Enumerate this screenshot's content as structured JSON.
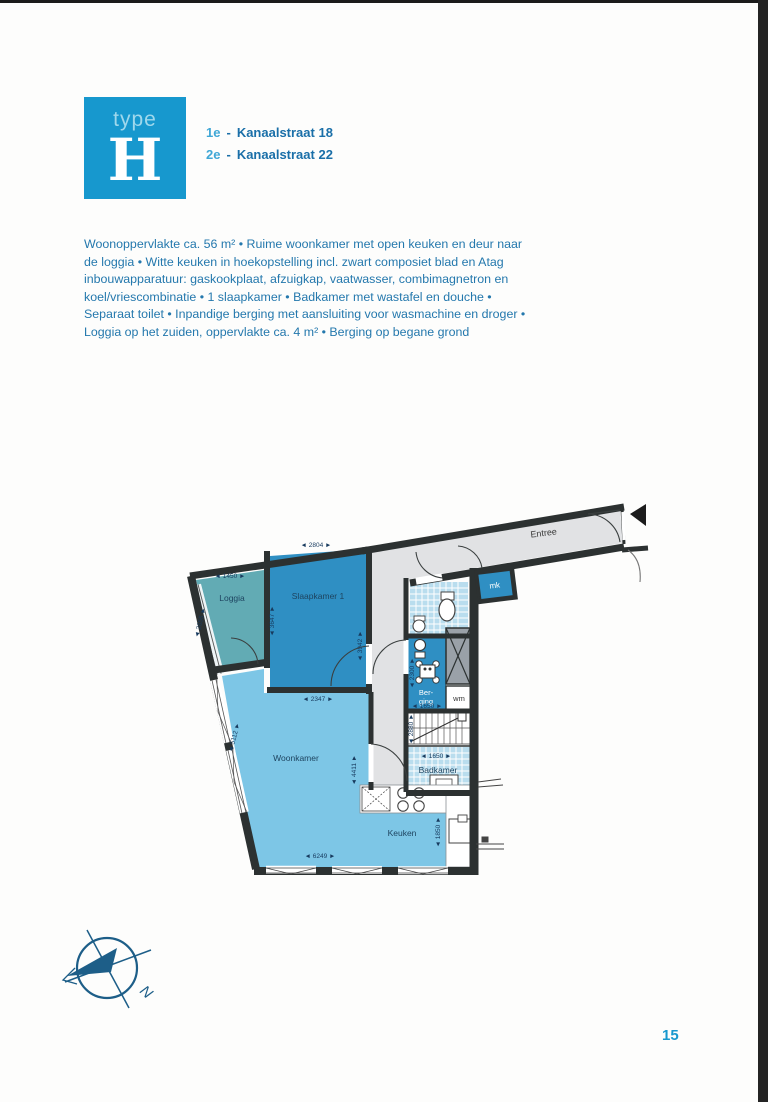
{
  "page": {
    "number": "15"
  },
  "logo": {
    "type_label": "type",
    "letter": "H",
    "bg_color": "#1798ce"
  },
  "addresses": [
    {
      "prefix": "1e",
      "sep": "-",
      "name": "Kanaalstraat 18"
    },
    {
      "prefix": "2e",
      "sep": "-",
      "name": "Kanaalstraat 22"
    }
  ],
  "description": "Woonoppervlakte ca. 56 m² • Ruime woonkamer met open keuken en deur naar de loggia • Witte keuken in hoekopstelling incl. zwart composiet blad en Atag inbouwapparatuur: gaskookplaat, afzuigkap, vaatwasser, combimagnetron en koel/vriescombinatie • 1 slaapkamer • Badkamer met wastafel en douche • Separaat toilet • Inpandige berging met aansluiting voor wasmachine en droger • Loggia op het zuiden, oppervlakte ca. 4 m² • Berging op begane grond",
  "floorplan": {
    "labels": {
      "entree": "Entree",
      "loggia": "Loggia",
      "slaapkamer": "Slaapkamer 1",
      "woonkamer": "Woonkamer",
      "keuken": "Keuken",
      "badkamer": "Badkamer",
      "berging_line1": "Ber-",
      "berging_line2": "ging",
      "mk": "mk",
      "wm": "wm"
    },
    "dimensions": {
      "slaapkamer_top": "◄ 2804 ►",
      "loggia_top": "◄ 1450 ►",
      "loggia_left": "◄ 2655 ►",
      "slaapkamer_left": "◄ 3647 ►",
      "slaapkamer_right": "◄ 3942 ►",
      "slaapkamer_bottom": "◄ 2347 ►",
      "woonkamer_left": "◄ 5112 ►",
      "keuken_left": "◄ 4411 ►",
      "woonkamer_bottom": "◄ 6249 ►",
      "berging_left": "◄ 2300 ►",
      "berging_bottom": "◄ 1650 ►",
      "trap_left": "◄ 2880 ►",
      "badkamer_top": "◄ 1650 ►",
      "keuken_right": "◄ 1850 ►"
    },
    "colors": {
      "wall": "#2c3131",
      "hall_floor": "#e1e2e4",
      "bedroom_blue": "#2f8fc3",
      "living_blue": "#7dc6e6",
      "loggia_teal": "#62abb4",
      "tile_blue": "#b9ddee"
    }
  },
  "compass": {
    "north_label": "N"
  }
}
